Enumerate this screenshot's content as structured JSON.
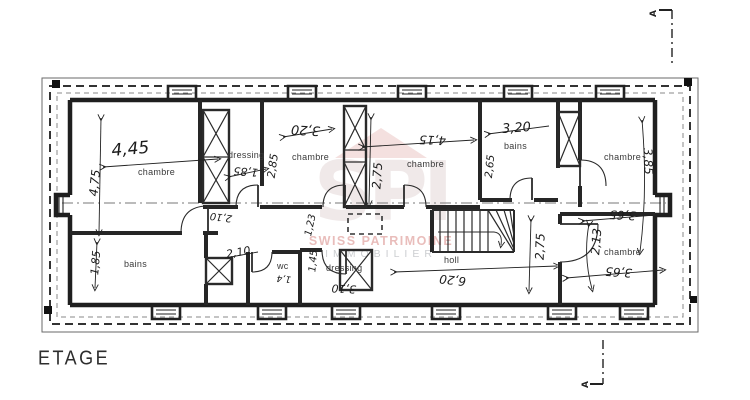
{
  "plan": {
    "title": "ETAGE",
    "section_marker": "A",
    "labels": {
      "chambre": "chambre",
      "bains": "bains",
      "dressing": "dressing",
      "wc": "wc",
      "hall": "holl"
    },
    "dims": {
      "d445": "4,45",
      "d475": "4,75",
      "d185a": "1,85",
      "d320a": "3,20",
      "d285": "2,85",
      "d415": "4,15",
      "d275a": "2,75",
      "d320b": "3,20",
      "d265": "2,65",
      "d385": "3,85",
      "d365a": "3,65",
      "d213": "2,13",
      "d365b": "3,65",
      "d620": "6,20",
      "d275b": "2,75",
      "d185b": "1,85",
      "d210a": "2,10",
      "d210b": "2,10",
      "d123": "1,23",
      "d145": "1,45",
      "d310": "3,10",
      "d14": "1,4"
    }
  },
  "watermark": {
    "monogram": "SPI",
    "line1": "SWISS PATRIMOINE",
    "line2": "IMMOBILIER"
  }
}
